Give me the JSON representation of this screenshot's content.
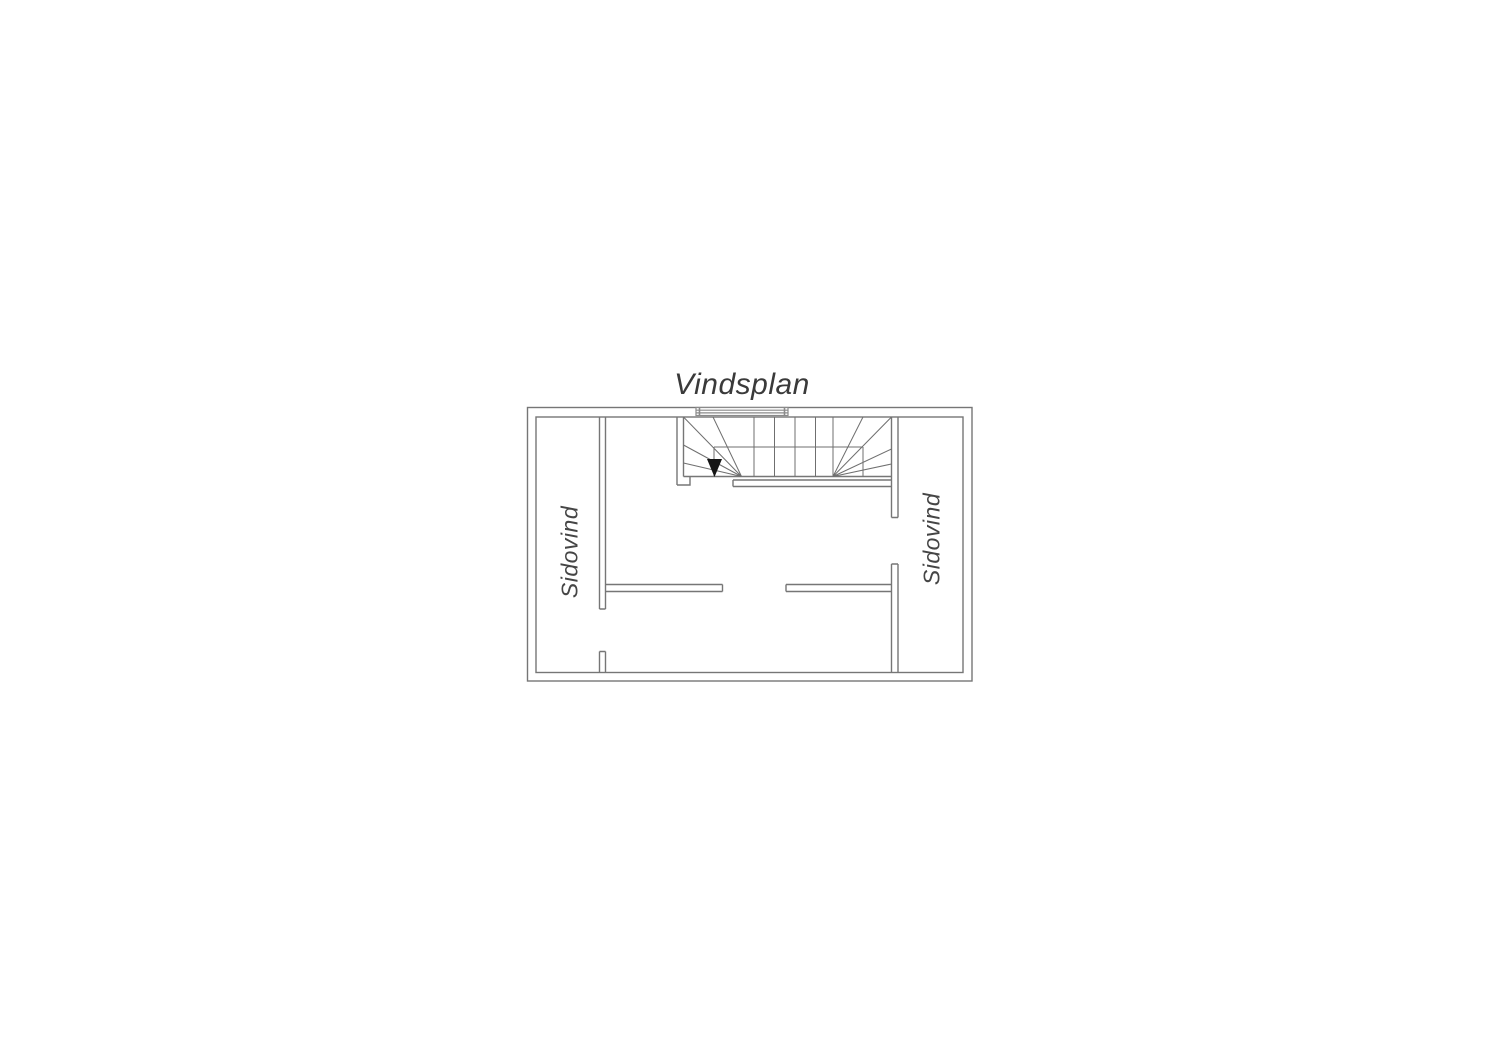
{
  "title": "Vindsplan",
  "rooms": {
    "left": {
      "label": "Sidovind"
    },
    "right": {
      "label": "Sidovind"
    }
  },
  "stair": {
    "direction_icon": "down-arrow"
  },
  "colors": {
    "wall_line": "#767676",
    "stair_line": "#6f6f6f",
    "window_line": "#8a8a8a",
    "text": "#3a3a3a",
    "arrow": "#151515",
    "background": "#ffffff"
  }
}
